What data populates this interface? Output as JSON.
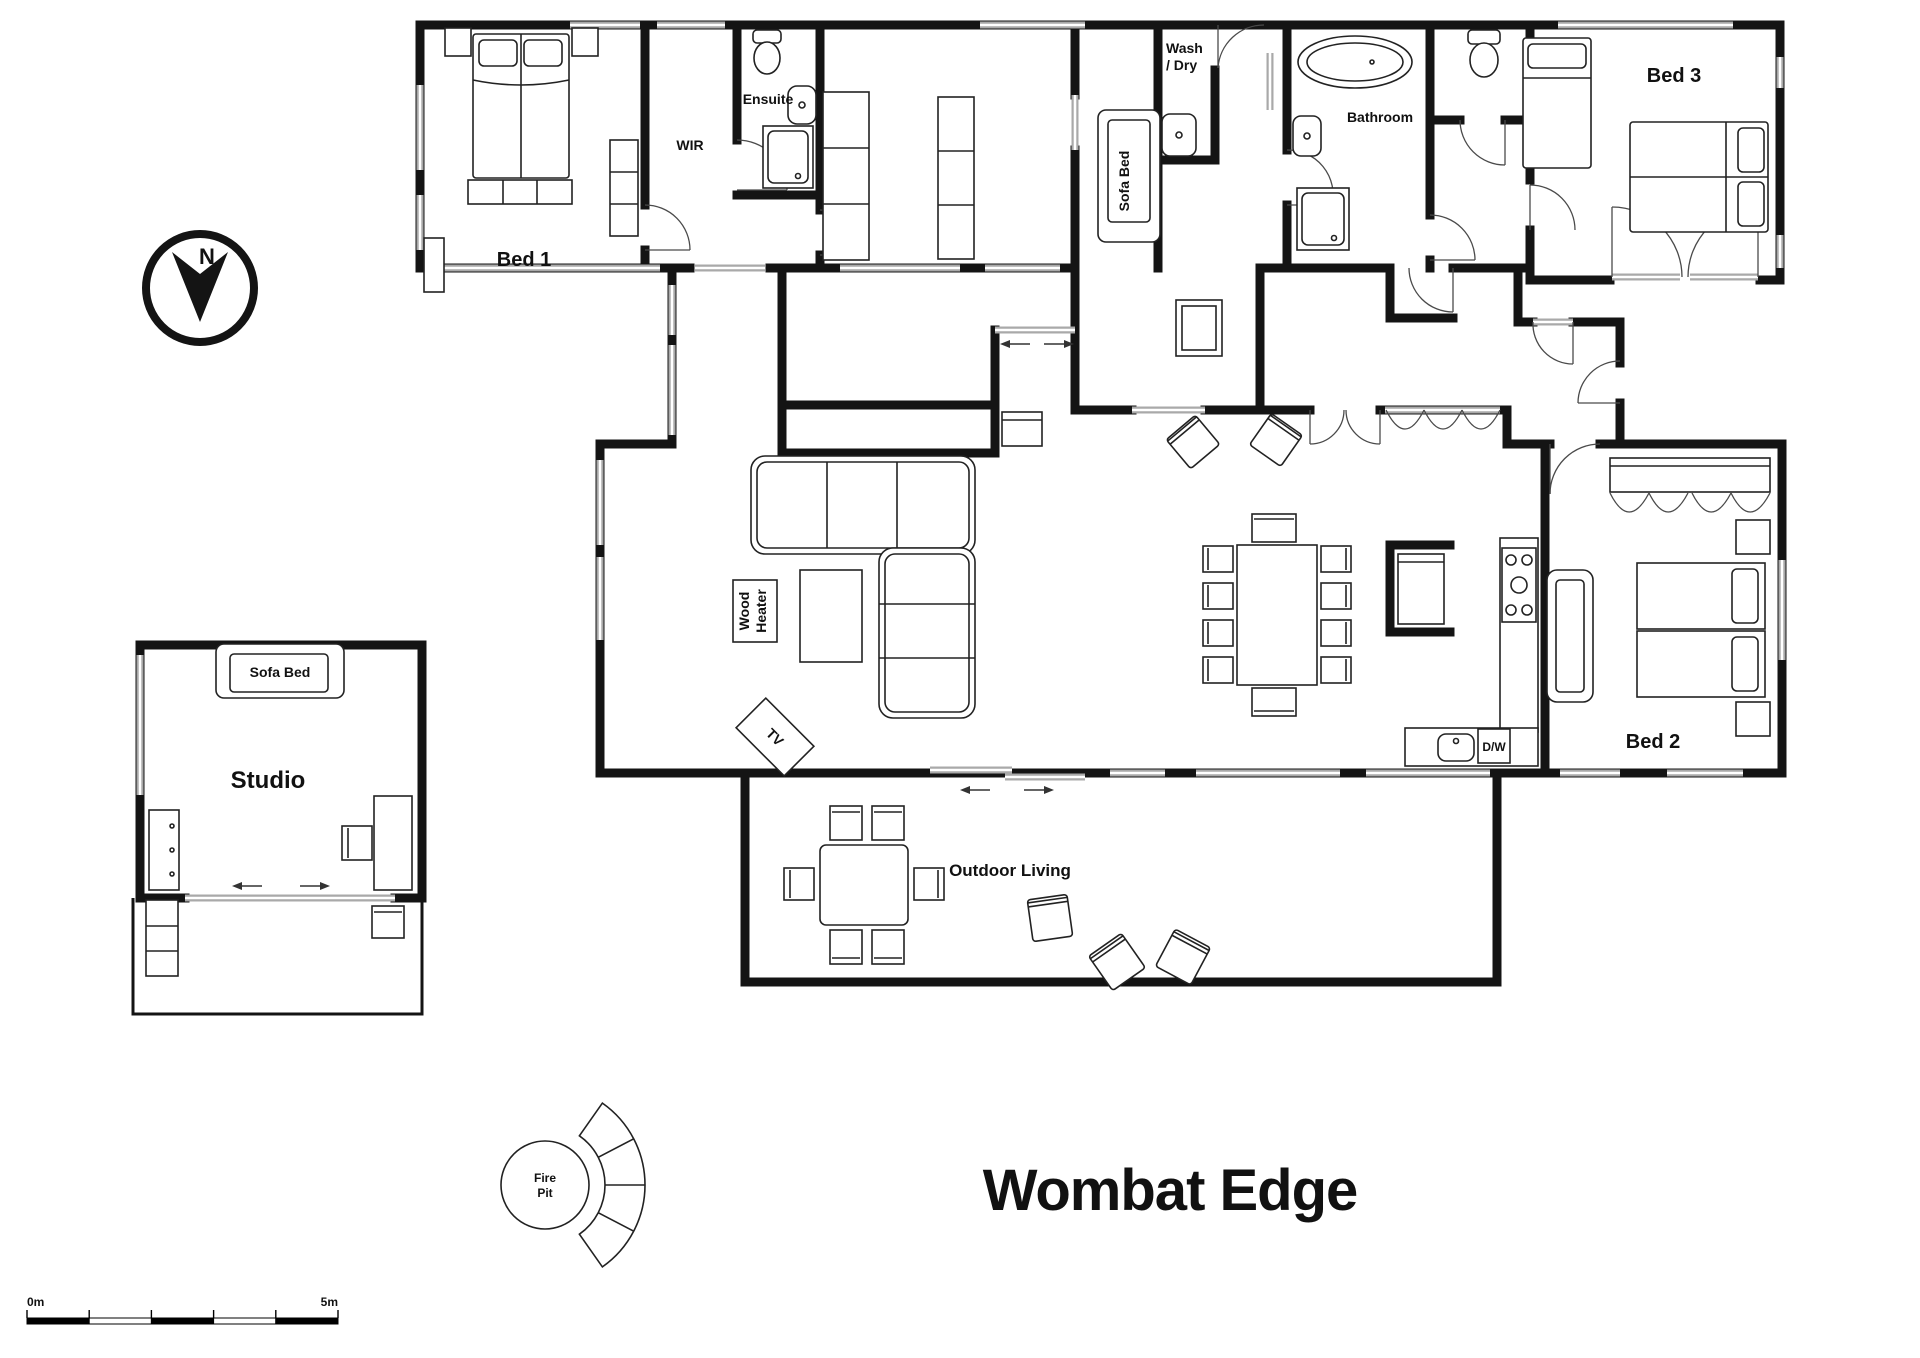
{
  "title": "Wombat Edge",
  "compass": {
    "north_label": "N"
  },
  "scale_bar": {
    "start": "0m",
    "end": "5m"
  },
  "rooms": {
    "bed1": {
      "label": "Bed 1"
    },
    "wir": {
      "label": "WIR"
    },
    "ensuite": {
      "label": "Ensuite"
    },
    "wash_dry": {
      "line1": "Wash",
      "line2": "/ Dry"
    },
    "sofa_bed_nook": {
      "label": "Sofa Bed"
    },
    "bathroom": {
      "label": "Bathroom"
    },
    "bed3": {
      "label": "Bed 3"
    },
    "bed2": {
      "label": "Bed 2"
    },
    "studio": {
      "label": "Studio",
      "sofa_bed_label": "Sofa Bed"
    },
    "outdoor_living": {
      "label": "Outdoor Living"
    }
  },
  "fixtures": {
    "wood_heater": {
      "line1": "Wood",
      "line2": "Heater"
    },
    "tv": {
      "label": "TV"
    },
    "dishwasher": {
      "label": "D/W"
    },
    "fire_pit": {
      "line1": "Fire",
      "line2": "Pit"
    }
  },
  "colors": {
    "wall": "#141414",
    "window": "#a9a9a9"
  }
}
